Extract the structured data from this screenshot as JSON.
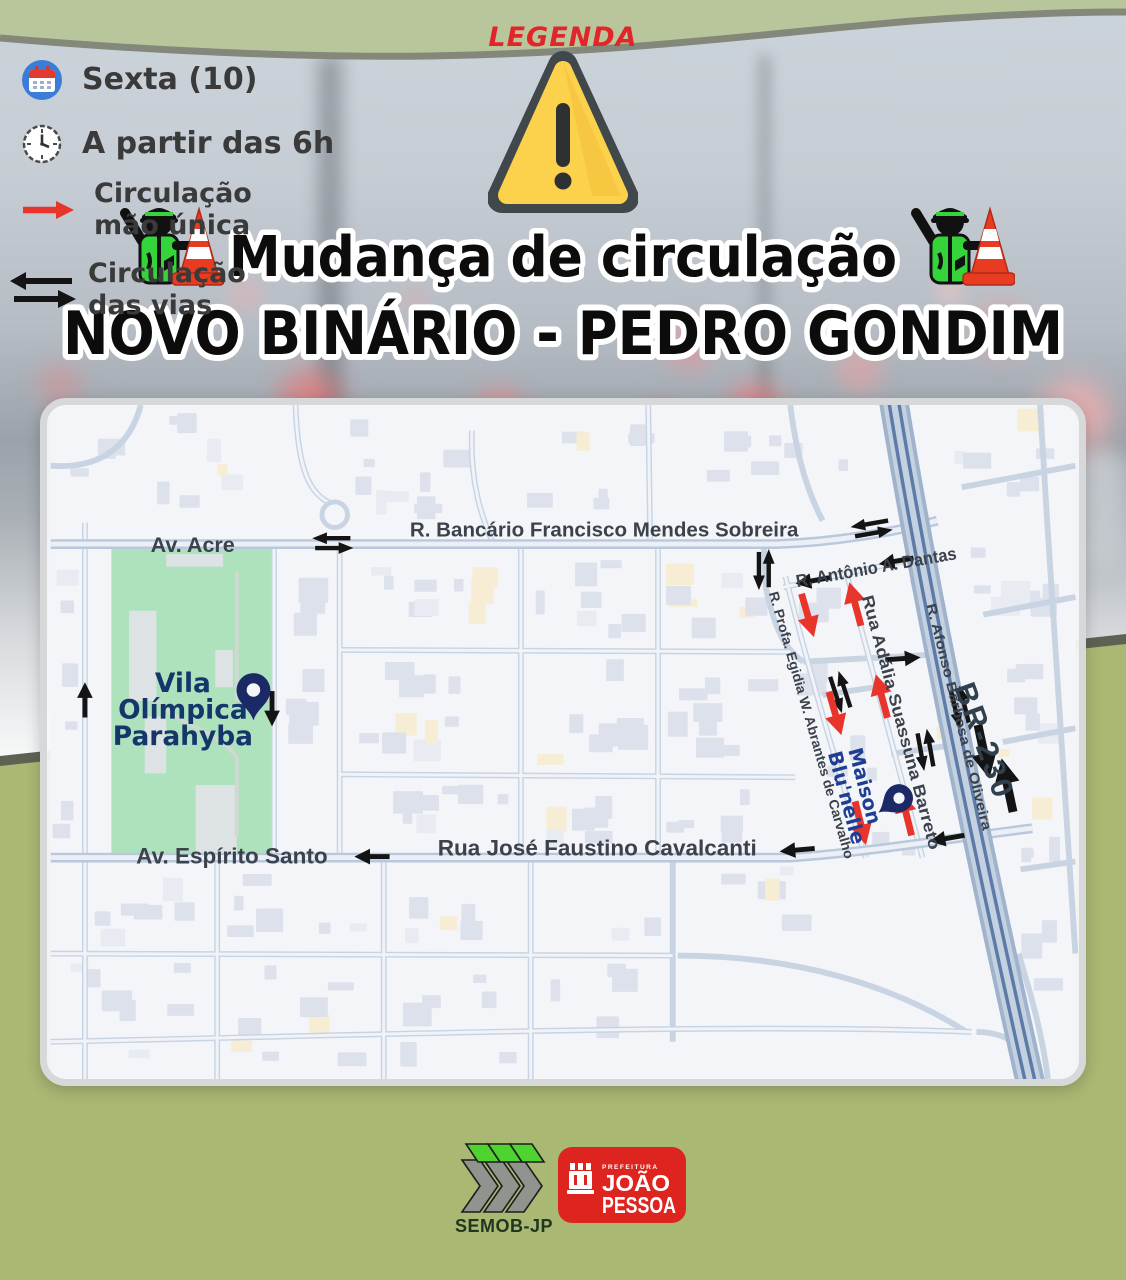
{
  "header": {
    "title": "Mudança de circulação",
    "subtitle": "NOVO BINÁRIO -  PEDRO GONDIM"
  },
  "map": {
    "street_labels": {
      "av_acre": "Av. Acre",
      "bancario_sobreira": "R. Bancário Francisco Mendes Sobreira",
      "antonio_dantas": "R. Antônio A. Dantas",
      "profa_egidia": "R. Profa. Egidia W. Abrantes de Carvalho",
      "adalia_suassuna": "Rua Adália Suassuna Barreto",
      "afonso_barbosa": "R. Afonso Barbosa de Oliveira",
      "br230": "BR-230",
      "espirito_santo": "Av. Espírito Santo",
      "jose_faustino": "Rua José Faustino Cavalcanti"
    },
    "place_labels": {
      "vila_olimpica_lines": [
        "Vila",
        "Olímpica",
        "Parahyba"
      ],
      "maison_lines": [
        "Maison",
        "Blu'nelle"
      ]
    }
  },
  "legend": {
    "title": "LEGENDA",
    "items": [
      {
        "icon": "calendar-icon",
        "label": "Sexta (10)"
      },
      {
        "icon": "clock-icon",
        "label": "A partir das 6h"
      },
      {
        "icon": "one-way-arrow-icon",
        "label_lines": [
          "Circulação",
          "mão única"
        ]
      },
      {
        "icon": "two-way-arrow-icon",
        "label_lines": [
          "Circulação",
          "das vias"
        ]
      }
    ]
  },
  "footer": {
    "semob_label": "SEMOB-JP",
    "prefeitura_small": "PREFEITURA",
    "joao": "JOÃO",
    "pessoa": "PESSOA"
  },
  "colors": {
    "one_way_arrow": "#e8352c",
    "two_way_arrow": "#141414",
    "navy_pin": "#1b2a66",
    "maison_blue": "#1d3e92",
    "park_green": "#ade2bc",
    "olive_bg": "#a9b873",
    "header_band": "#b9c69c",
    "warning_yellow": "#fcd14b",
    "legend_red": "#e0262a"
  }
}
